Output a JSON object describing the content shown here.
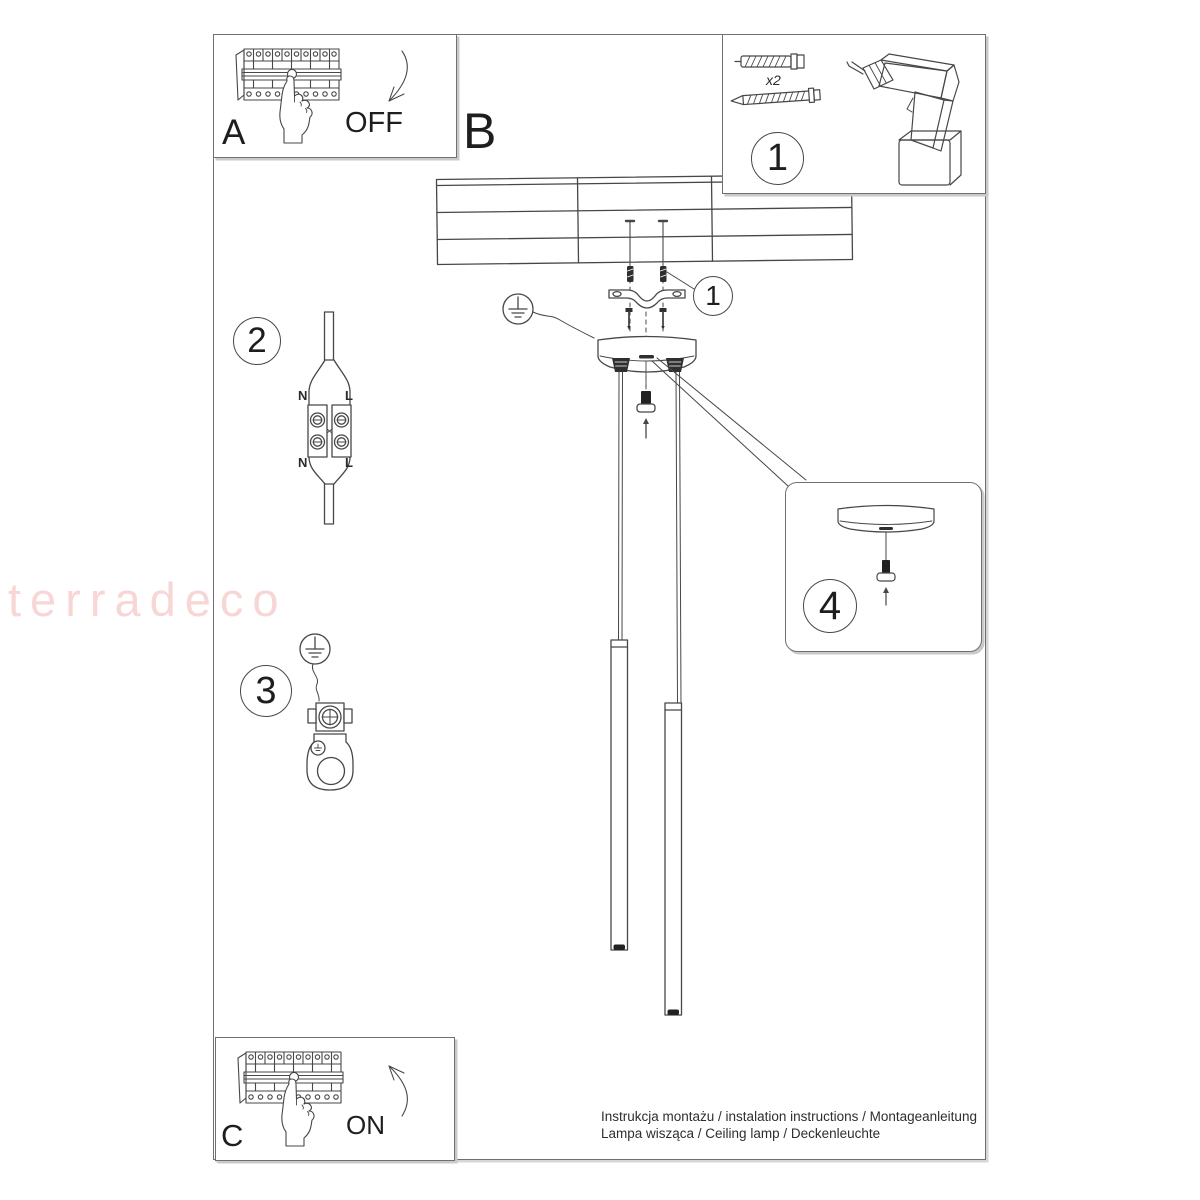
{
  "watermark": {
    "text": "terradeco",
    "color": "#f8d6d6"
  },
  "steps": {
    "a": "A",
    "b": "B",
    "c": "C"
  },
  "actions": {
    "off": "OFF",
    "on": "ON"
  },
  "callouts": {
    "parts": "1",
    "bracket": "1",
    "wiring": "2",
    "ground": "3",
    "canopy_detail": "4"
  },
  "parts": {
    "anchor_qty": "x2"
  },
  "wiring_labels": {
    "n_top": "N",
    "l_top": "L",
    "n_bottom": "N",
    "l_bottom": "L"
  },
  "footer": {
    "line1": "Instrukcja montażu / instalation instructions / Montageanleitung",
    "line2": "Lampa wisząca / Ceiling lamp / Deckenleuchte"
  },
  "colors": {
    "line": "#474747",
    "panel_border": "#707070",
    "watermark": "#f8d6d6",
    "dark_fill": "#2f2f2f"
  }
}
